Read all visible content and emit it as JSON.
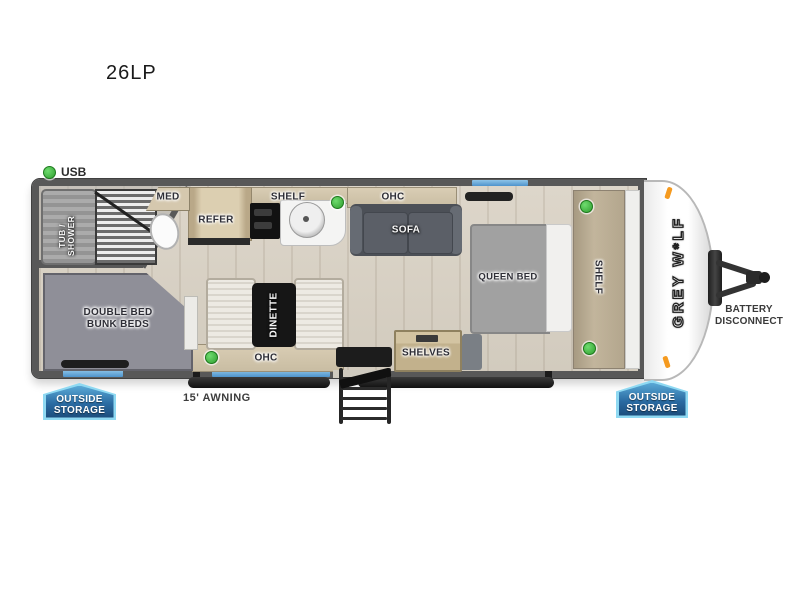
{
  "header": {
    "model": "26LP"
  },
  "legend": {
    "usb": "USB"
  },
  "trailer": {
    "brand_logo": "GREY W*LF",
    "rooms": {
      "bathroom": {
        "tub_line1": "TUB /",
        "tub_line2": "SHOWER",
        "med_label": "MED"
      },
      "kitchen": {
        "refer_label": "REFER",
        "shelf_label": "SHELF"
      },
      "living": {
        "ohc_label": "OHC",
        "sofa_label": "SOFA"
      },
      "bedroom": {
        "bed_label": "QUEEN BED",
        "shelf_label": "SHELF"
      },
      "bunk_room": {
        "label_line1": "DOUBLE BED",
        "label_line2": "BUNK BEDS"
      },
      "dinette": {
        "table_label": "DINETTE",
        "ohc_label": "OHC"
      },
      "entry": {
        "shelves_label": "SHELVES"
      }
    },
    "exterior": {
      "awning_label": "15' AWNING",
      "battery_line1": "BATTERY",
      "battery_line2": "DISCONNECT",
      "storage_line1": "OUTSIDE",
      "storage_line2": "STORAGE"
    }
  },
  "colors": {
    "wall_gray": "#585858",
    "floor_tan": "#d8d1c5",
    "window_blue": "#5aa0d8",
    "usb_green": "#3fbf3f",
    "marker_orange": "#f59a1f",
    "badge_blue_top": "#5aa9d6",
    "badge_blue_bottom": "#1c4d7c"
  }
}
